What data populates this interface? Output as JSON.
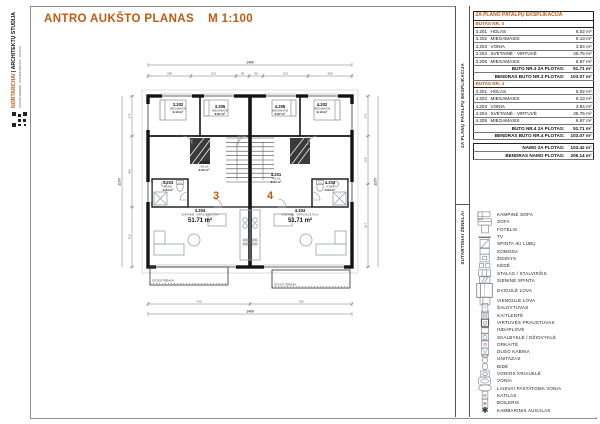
{
  "page": {
    "title": "ANTRO AUKŠTO PLANAS",
    "scale": "M 1:100"
  },
  "logo": {
    "brand": "NORTARCHAI",
    "studio": "| ARCHITEKTŲ STUDIJA",
    "tagline": "PROJEKTAVIMAS · KONSULTACIJOS · VILNIUS"
  },
  "explication": {
    "panel_label": "2A PLANŲ PATALPŲ EKSPLIKACIJA",
    "title": "2A PLANO PATALPŲ EKSPLIKACIJA",
    "sections": [
      {
        "heading": "BUTAS NR. 3",
        "rows": [
          [
            "3.201",
            "HOLAS",
            "6.02 m²"
          ],
          [
            "3.202",
            "MIEGAMASIS",
            "9.13 m²"
          ],
          [
            "3.203",
            "VONIA",
            "3.84 m²"
          ],
          [
            "3.204",
            "SVETAINĖ - VIRTUVĖ",
            "25.75 m²"
          ],
          [
            "3.205",
            "MIEGAMASIS",
            "6.97 m²"
          ]
        ],
        "summaries": [
          [
            "BUTO NR.3 2A PLOTAS:",
            "51.71 m²"
          ],
          [
            "BENDRAS BUTO NR.3 PLOTAS:",
            "103.07 m²"
          ]
        ]
      },
      {
        "heading": "BUTAS NR. 4",
        "rows": [
          [
            "4.201",
            "HOLAS",
            "6.02 m²"
          ],
          [
            "4.202",
            "MIEGAMASIS",
            "9.13 m²"
          ],
          [
            "4.203",
            "VONIA",
            "3.84 m²"
          ],
          [
            "4.204",
            "SVETAINĖ - VIRTUVĖ",
            "25.75 m²"
          ],
          [
            "4.205",
            "MIEGAMASIS",
            "6.97 m²"
          ]
        ],
        "summaries": [
          [
            "BUTO NR.4 2A PLOTAS:",
            "51.71 m²"
          ],
          [
            "BENDRAS BUTO NR.4 PLOTAS:",
            "103.07 m²"
          ]
        ]
      }
    ],
    "totals": [
      [
        "NAMO 2A PLOTAS:",
        "103.42 m²"
      ],
      [
        "BENDRAS NAMO PLOTAS:",
        "206.14 m²"
      ]
    ]
  },
  "legend": {
    "panel_label": "SUTARTINIAI ŽENKLAI",
    "items": [
      {
        "icon": "corner-sofa-icon",
        "label": "KAMPINĖ SOFA"
      },
      {
        "icon": "sofa-icon",
        "label": "SOFA"
      },
      {
        "icon": "armchair-icon",
        "label": "FOTELIS"
      },
      {
        "icon": "tv-icon",
        "label": "TV"
      },
      {
        "icon": "wardrobe-icon",
        "label": "SPINTA IKI LUBŲ"
      },
      {
        "icon": "dresser-icon",
        "label": "KOMODA"
      },
      {
        "icon": "fireplace-icon",
        "label": "ŽIDINYS"
      },
      {
        "icon": "chair-icon",
        "label": "KĖDĖ"
      },
      {
        "icon": "table-icon",
        "label": "STALAS / STALVIRŠIS"
      },
      {
        "icon": "wall-closet-icon",
        "label": "SIENINĖ SPINTA"
      },
      {
        "icon": "double-bed-icon",
        "label": "DVIGULĖ LOVA"
      },
      {
        "icon": "single-bed-icon",
        "label": "VIENGULĖ LOVA"
      },
      {
        "icon": "fridge-icon",
        "label": "ŠALDYTUVAS"
      },
      {
        "icon": "hob-icon",
        "label": "KAITLENTĖ"
      },
      {
        "icon": "kitchen-sink-icon",
        "label": "VIRTUVĖS PRAUSTUVAS"
      },
      {
        "icon": "dishwasher-icon",
        "label": "INDAPLOVĖ"
      },
      {
        "icon": "washer-dryer-icon",
        "label": "SKALBYKLĖ / DŽIOVYKLĖ"
      },
      {
        "icon": "oven-icon",
        "label": "ORKAITĖ"
      },
      {
        "icon": "shower-icon",
        "label": "DUŠO KABINA"
      },
      {
        "icon": "toilet-icon",
        "label": "UNITAZAS"
      },
      {
        "icon": "bidet-icon",
        "label": "BIDĖ"
      },
      {
        "icon": "bathroom-sink-icon",
        "label": "VONIOS KRIAUKLĖ"
      },
      {
        "icon": "bathtub-icon",
        "label": "VONIA"
      },
      {
        "icon": "freestanding-tub-icon",
        "label": "LAISVAI PASTATOMA VONIA"
      },
      {
        "icon": "boiler-unit-icon",
        "label": "KATILAS"
      },
      {
        "icon": "water-heater-icon",
        "label": "BOILERIS"
      },
      {
        "icon": "plant-icon",
        "label": "KAMBARINIS AUGALAS"
      }
    ]
  },
  "plan": {
    "units": [
      {
        "number": "3"
      },
      {
        "number": "4"
      }
    ],
    "rooms": [
      {
        "id": "3.202",
        "name": "MIEGAMASIS",
        "area": "9.13 m²"
      },
      {
        "id": "3.205",
        "name": "MIEGAMASIS",
        "area": "6.97 m²"
      },
      {
        "id": "3.201",
        "name": "HOLAS",
        "area": "6.02 m²"
      },
      {
        "id": "3.203",
        "name": "VONIA",
        "area": "3.84 m²"
      },
      {
        "id": "3.204",
        "name": "SVETAINĖ - VIRTUVĖ 25.75 m²",
        "area_big": "51.71 m²"
      },
      {
        "id": "4.202",
        "name": "MIEGAMASIS",
        "area": "9.13 m²"
      },
      {
        "id": "4.205",
        "name": "MIEGAMASIS",
        "area": "6.97 m²"
      },
      {
        "id": "4.201",
        "name": "HOLAS",
        "area": "6.02 m²"
      },
      {
        "id": "4.203",
        "name": "VONIA",
        "area": "3.84 m²"
      },
      {
        "id": "4.204",
        "name": "SVETAINĖ - VIRTUVĖ 25.75 m²",
        "area_big": "51.71 m²"
      }
    ],
    "terrace_note": "STOGO TERASA",
    "dims": {
      "total_width": "1400",
      "total_height": "1170",
      "top_chain": [
        "298",
        "312",
        "90",
        "90",
        "312",
        "298"
      ],
      "bottom_chain": [
        "700",
        "700"
      ],
      "left_chain": [
        "274",
        "486",
        "410"
      ],
      "right_chain": [
        "274",
        "329",
        "567"
      ]
    }
  },
  "accent_color": "#c05a11"
}
